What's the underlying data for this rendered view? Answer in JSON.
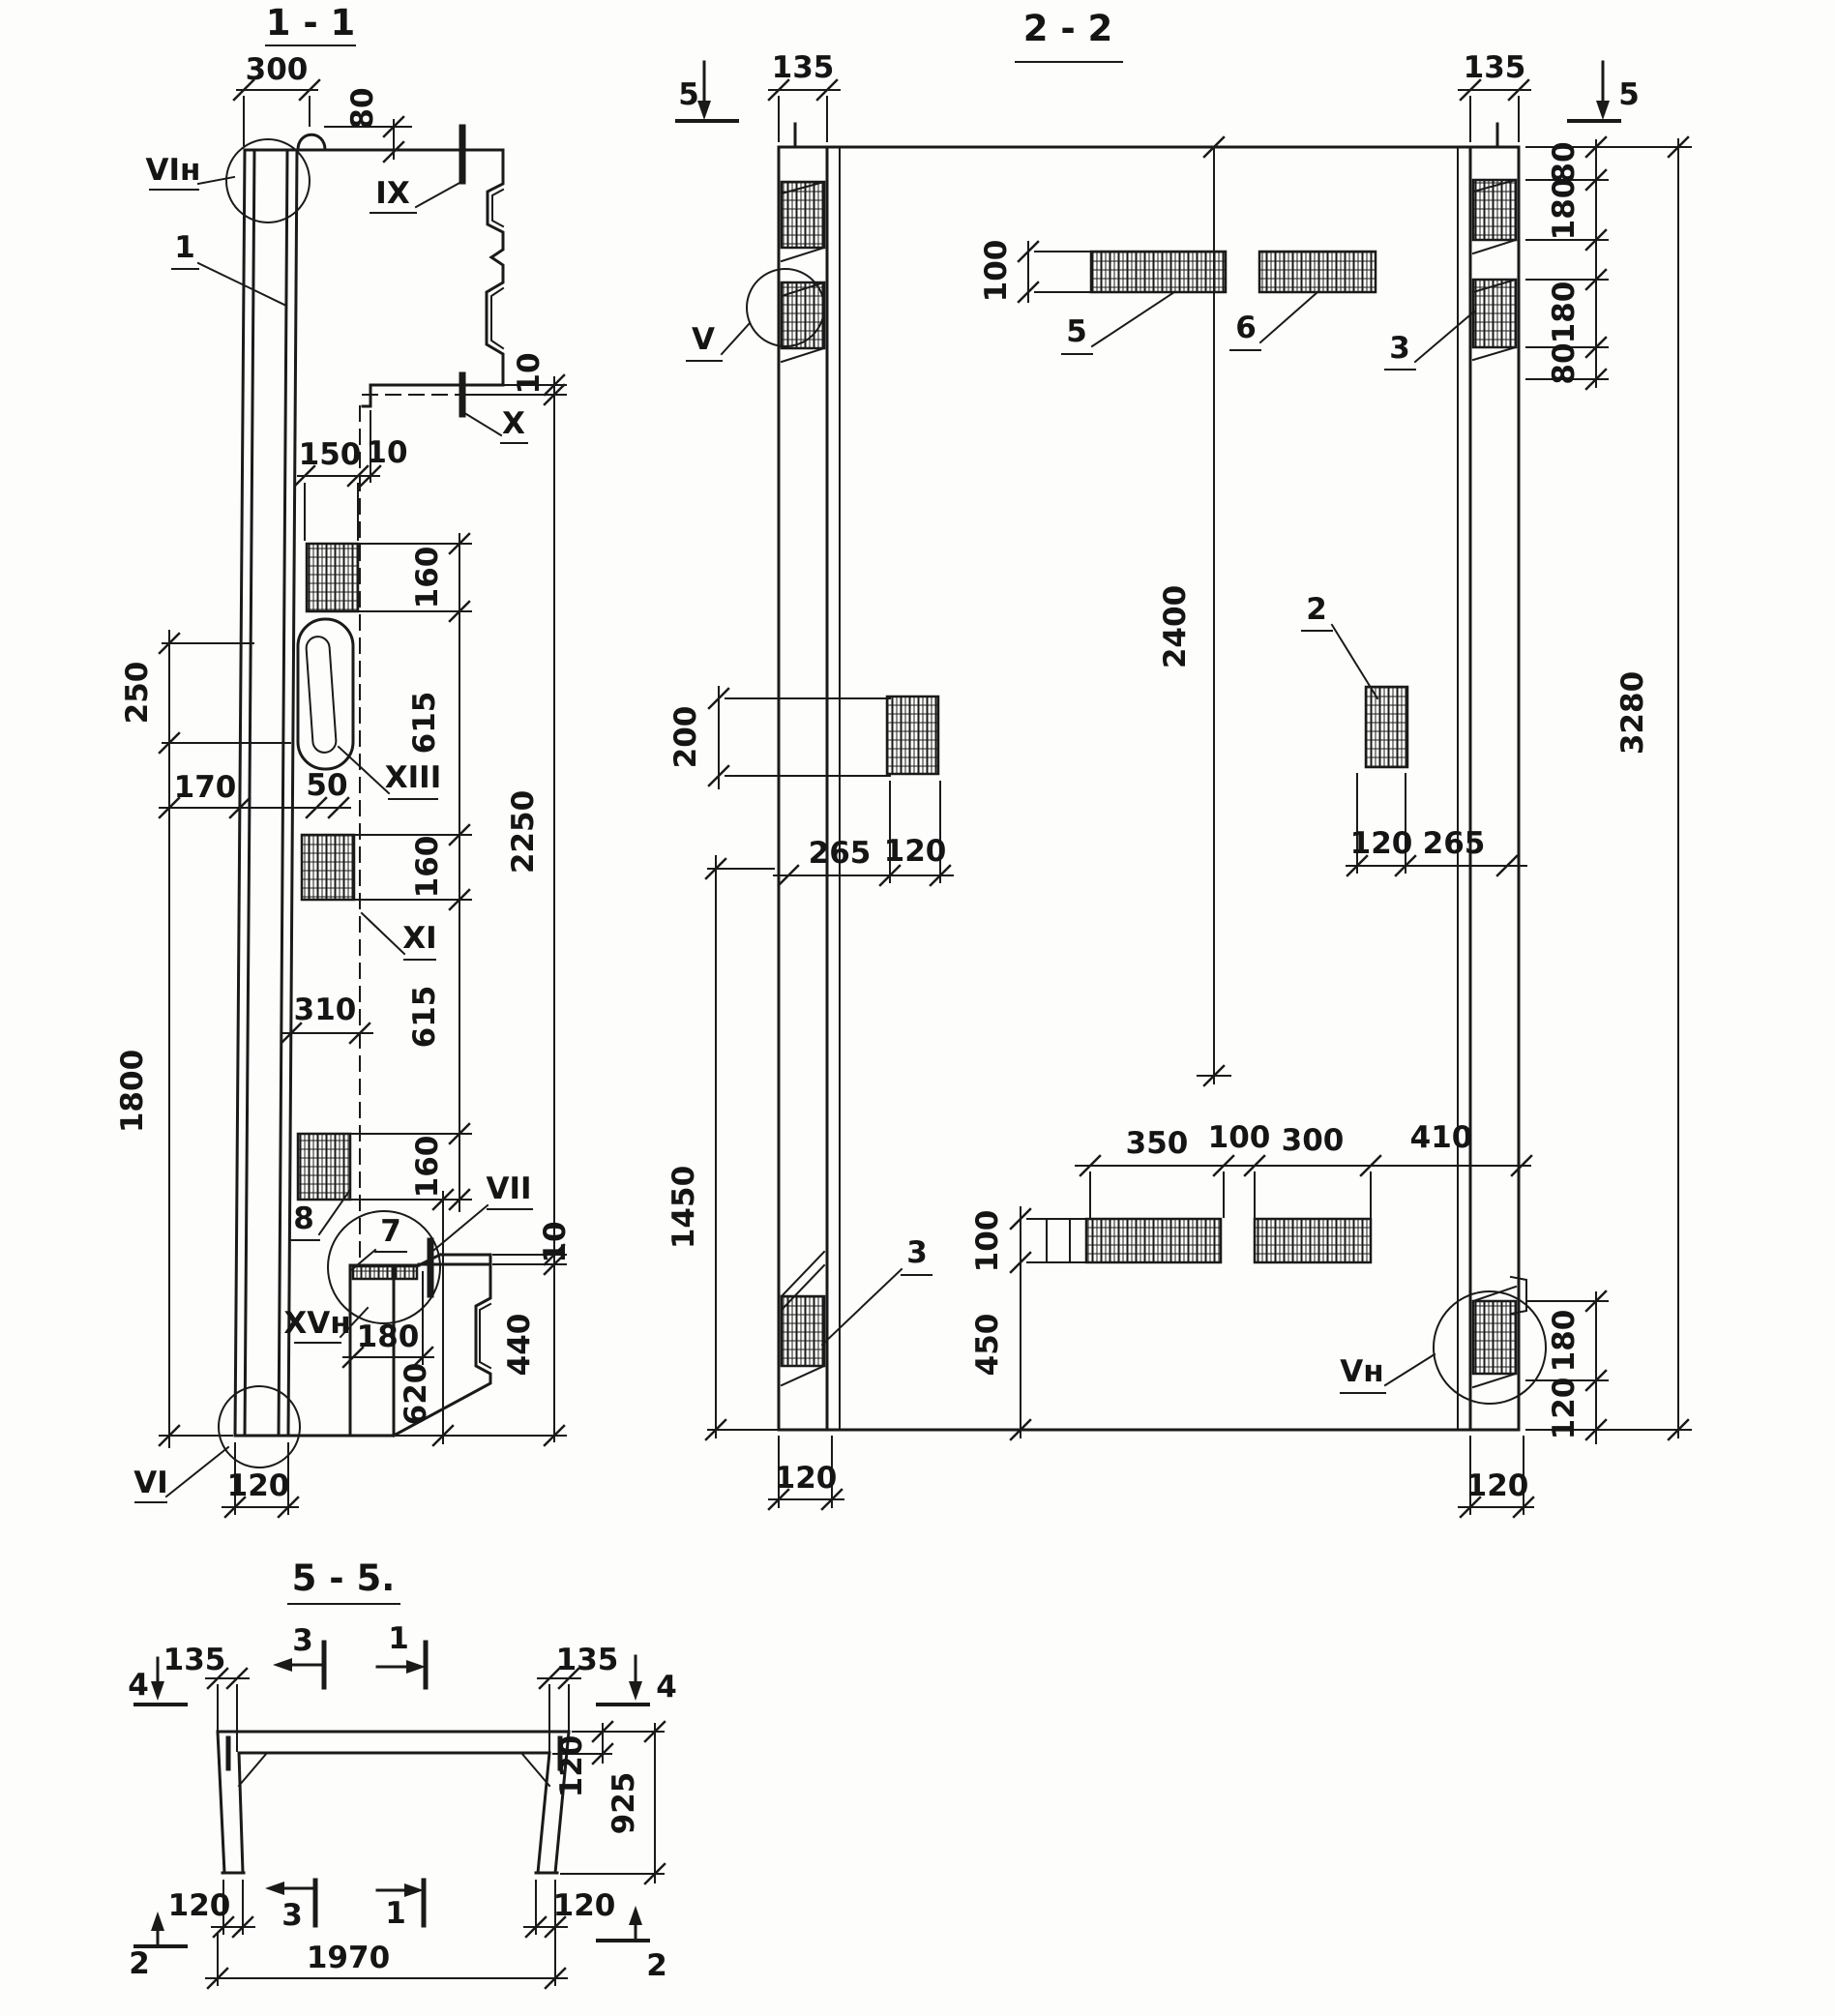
{
  "s11": {
    "title": "1 - 1",
    "labels": {
      "vih": "VIн",
      "n1": "1",
      "ix": "IX",
      "x": "X",
      "xiii": "XIII",
      "xi": "XI",
      "n8": "8",
      "n7": "7",
      "vii": "VII",
      "xvh": "XVн",
      "vi": "VI"
    },
    "dims": {
      "d300": "300",
      "d80": "80",
      "d10_step": "10",
      "d150": "150",
      "d10_gap": "10",
      "d160_1": "160",
      "d615_1": "615",
      "d160_2": "160",
      "d615_2": "615",
      "d160_3": "160",
      "d2250": "2250",
      "d250": "250",
      "d1800": "1800",
      "d170": "170",
      "d50": "50",
      "d310": "310",
      "d180": "180",
      "d620": "620",
      "d10_foot": "10",
      "d440": "440",
      "d120": "120"
    }
  },
  "s22": {
    "title": "2 - 2",
    "markers": {
      "m5_left": "5",
      "m5_right": "5"
    },
    "labels": {
      "v": "V",
      "vn": "Vн",
      "n2": "2",
      "n3_top": "3",
      "n3_bot": "3",
      "n5": "5",
      "n6": "6"
    },
    "dims": {
      "d135_l": "135",
      "d135_r": "135",
      "d100_top": "100",
      "d80_a": "80",
      "d180_a": "180",
      "d180_b": "180",
      "d80_b": "80",
      "d3280": "3280",
      "d2400": "2400",
      "d200": "200",
      "d265_l": "265",
      "d120_l": "120",
      "d120_r": "120",
      "d265_r": "265",
      "d1450": "1450",
      "d350": "350",
      "d100_mid": "100",
      "d300": "300",
      "d410": "410",
      "d100_bot": "100",
      "d450": "450",
      "d180_br": "180",
      "d120_br": "120",
      "d120_bl": "120",
      "d120_brb": "120"
    }
  },
  "s55": {
    "title": "5 - 5.",
    "markers": {
      "m3_top": "3",
      "m1_top": "1",
      "m4_l": "4",
      "m4_r": "4",
      "m3_bot": "3",
      "m1_bot": "1",
      "m2_l": "2",
      "m2_r": "2"
    },
    "dims": {
      "d135_l": "135",
      "d135_r": "135",
      "d120_tr": "120",
      "d925": "925",
      "d120_bl": "120",
      "d120_br": "120",
      "d1970": "1970"
    }
  }
}
